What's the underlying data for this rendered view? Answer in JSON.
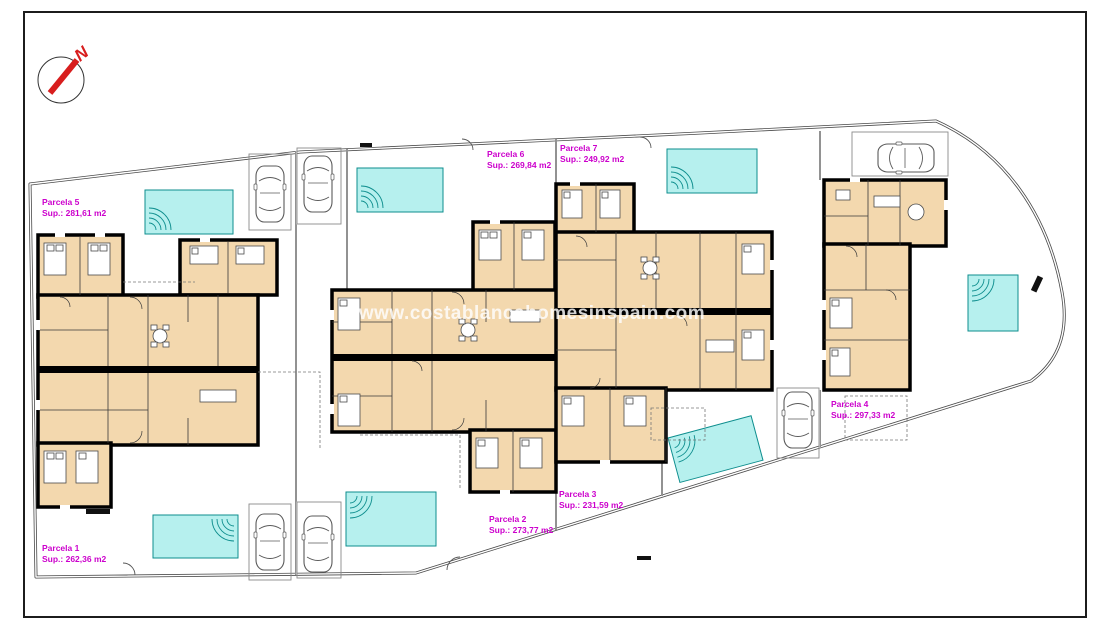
{
  "watermark": "www.costablancahomesinspain.com",
  "compass": {
    "label": "N"
  },
  "colors": {
    "pool": "#b6f0ee",
    "pool_border": "#0e8e8e",
    "house_fill": "#f3d8ae",
    "wall": "#000000",
    "parcel_label": "#cc00cc",
    "compass_red": "#d81e1e",
    "boundary_line": "#4a4a4a"
  },
  "parcels": [
    {
      "name": "Parcela 1",
      "sup": "Sup.: 262,36 m2"
    },
    {
      "name": "Parcela 2",
      "sup": "Sup.: 273,77 m2"
    },
    {
      "name": "Parcela 3",
      "sup": "Sup.: 231,59 m2"
    },
    {
      "name": "Parcela 4",
      "sup": "Sup.: 297,33 m2"
    },
    {
      "name": "Parcela 5",
      "sup": "Sup.: 281,61 m2"
    },
    {
      "name": "Parcela 6",
      "sup": "Sup.: 269,84 m2"
    },
    {
      "name": "Parcela 7",
      "sup": "Sup.: 249,92 m2"
    }
  ]
}
